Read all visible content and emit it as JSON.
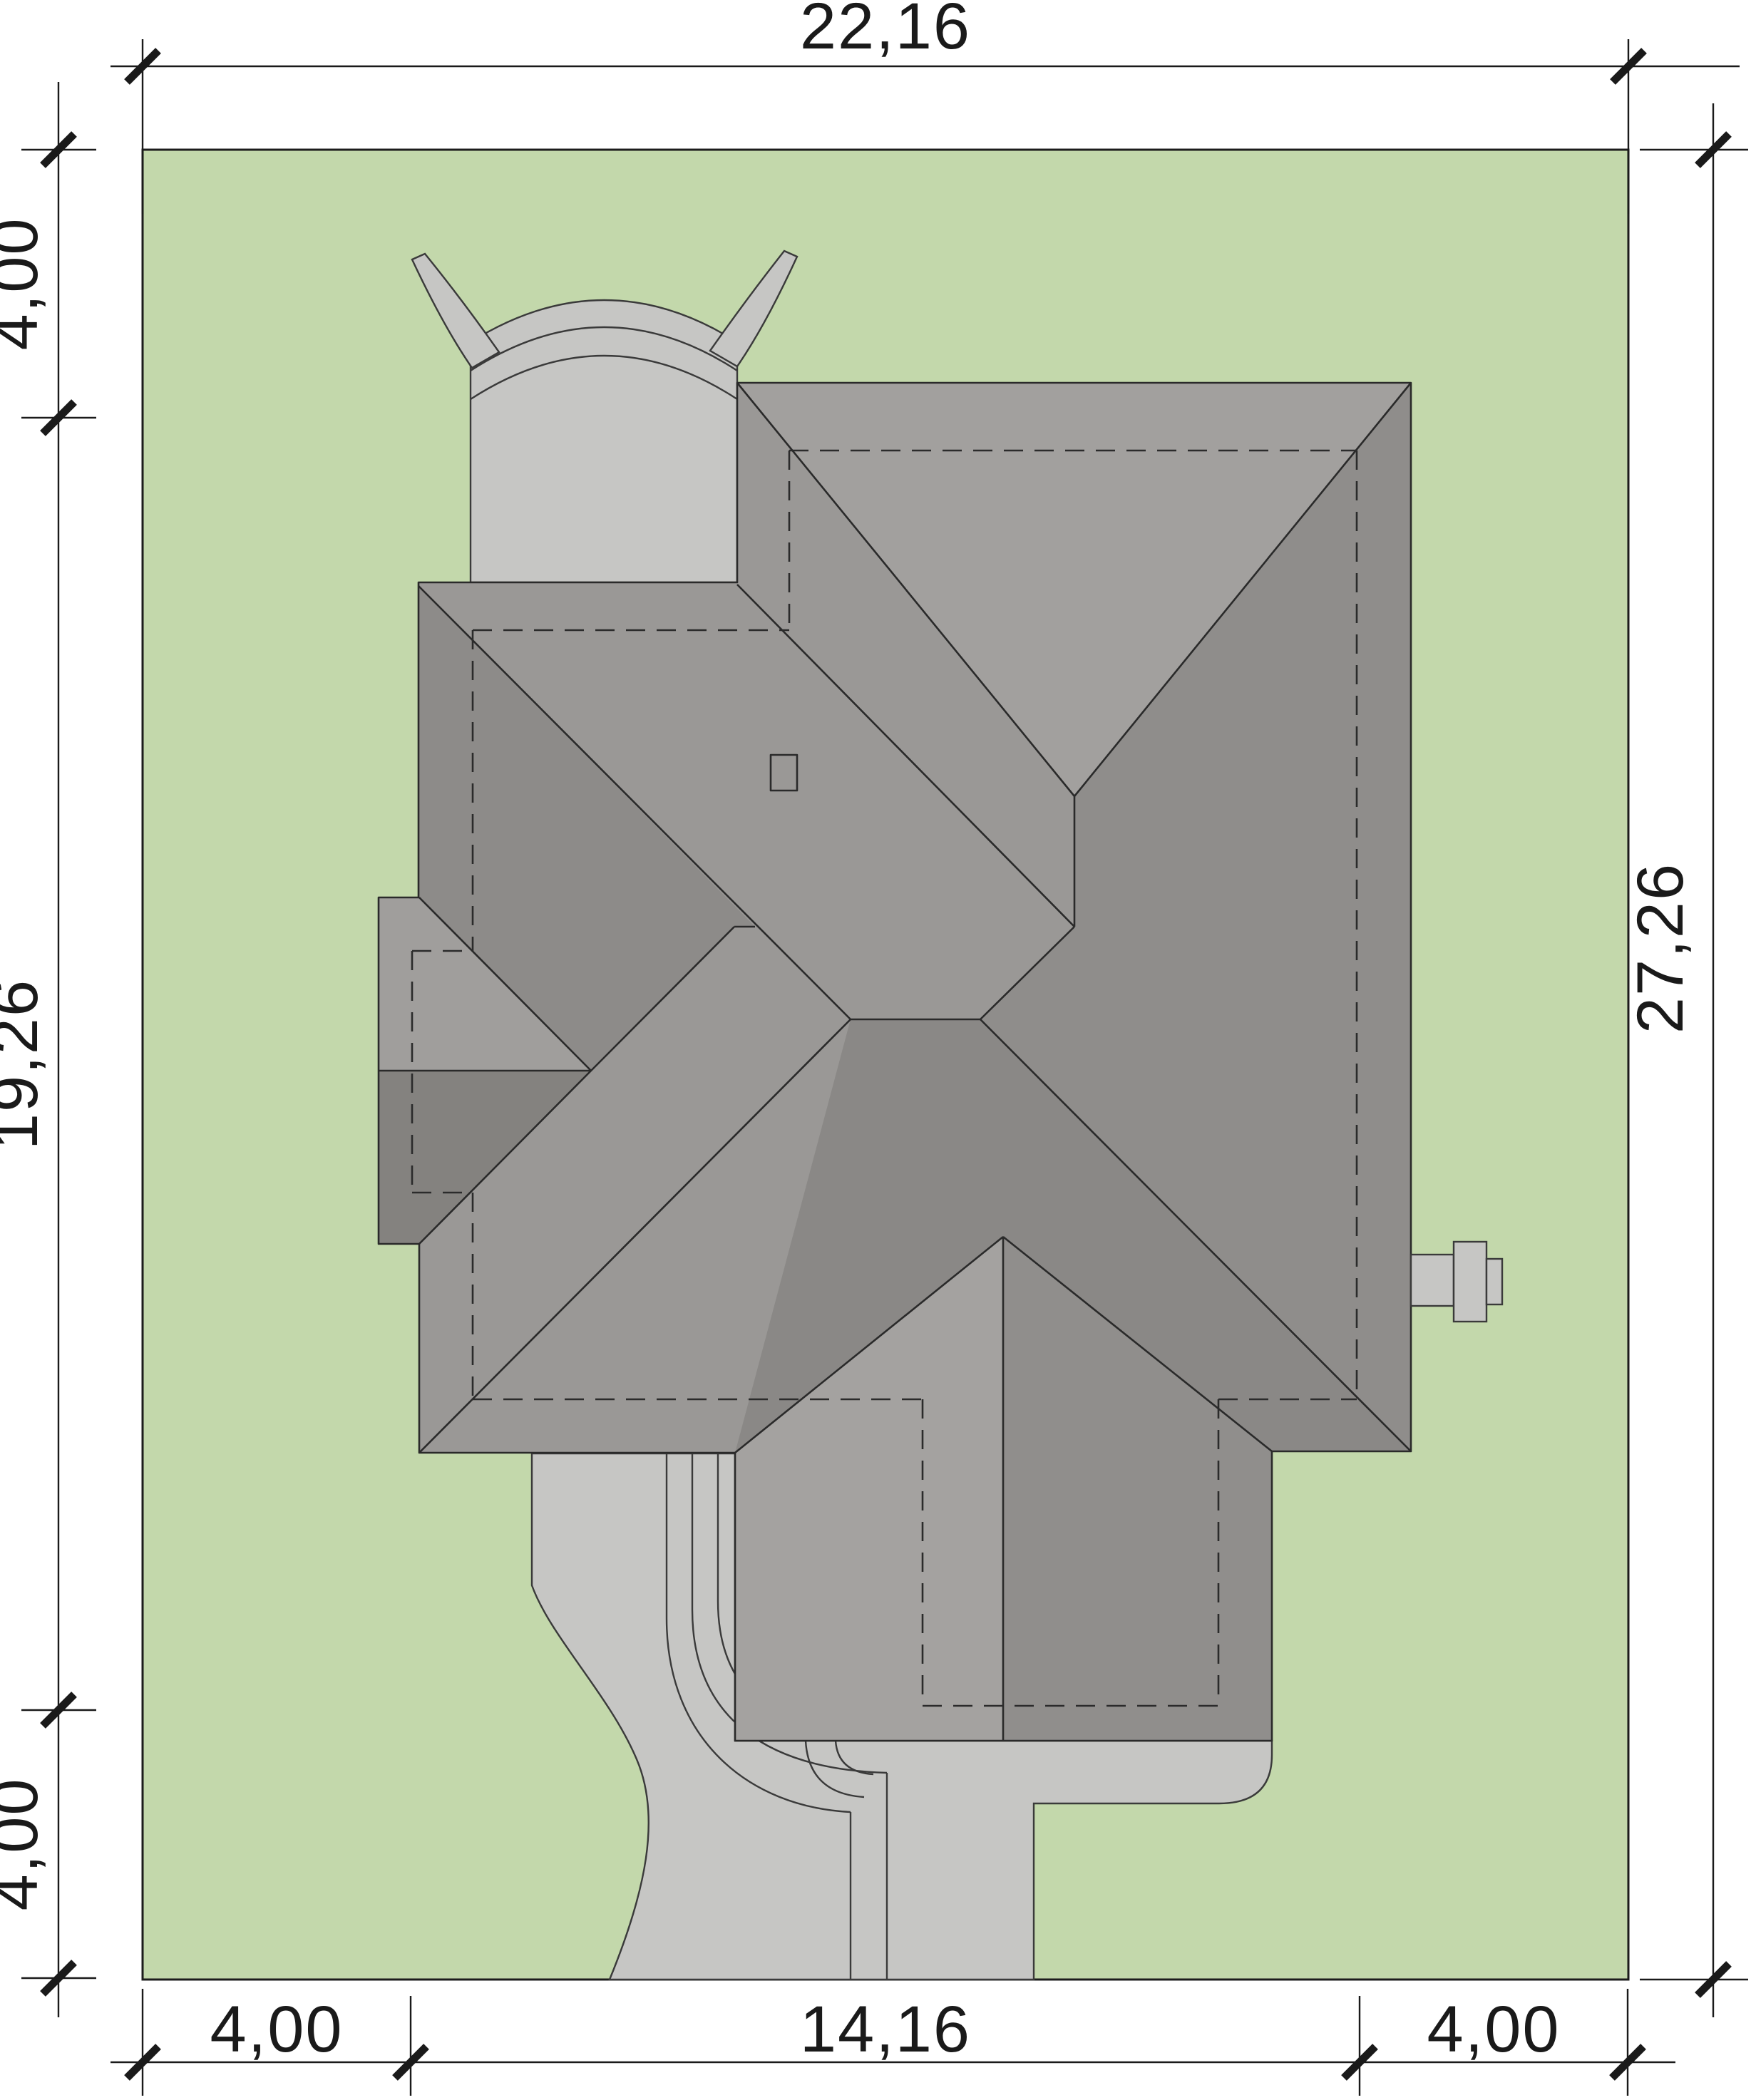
{
  "drawing": {
    "type": "architectural-site-plan",
    "units": "meters"
  },
  "dimensions": {
    "top": {
      "label": "22,16"
    },
    "right": {
      "label": "27,26"
    },
    "left": {
      "top": "4,00",
      "middle": "19,26",
      "bottom": "4,00"
    },
    "bottom": {
      "left": "4,00",
      "center": "14,16",
      "right": "4,00"
    }
  },
  "colors": {
    "plot_green": "#c3d8ab",
    "paving": "#c6c6c4",
    "roof_base": "#9a9896",
    "roof_north": "#a2a09e",
    "roof_east": "#8f8d8b",
    "roof_south": "#8a8886",
    "garage_dark": "#8d8b89",
    "wing_light": "#a09e9c",
    "wing_dark": "#84827f",
    "gable_west": "#a4a2a0",
    "gable_east": "#908e8c",
    "roof_window": "#b3b3b1",
    "dim_text": "#1a1a1a"
  }
}
